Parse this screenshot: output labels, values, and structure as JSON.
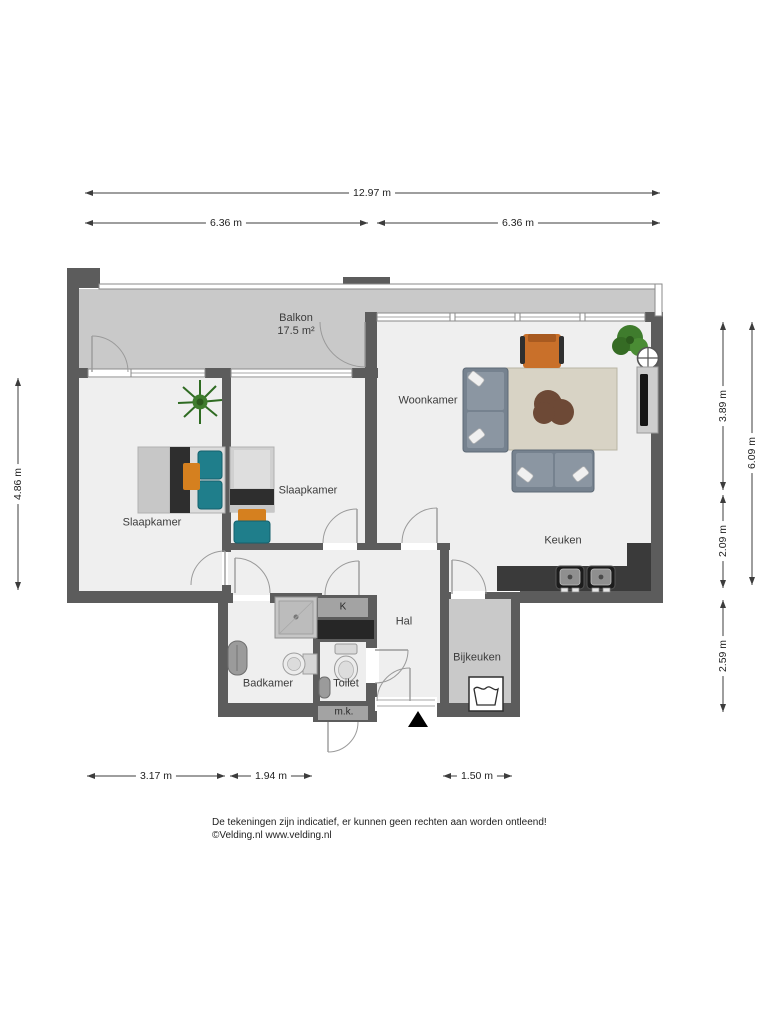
{
  "plan": {
    "rooms": {
      "balkon": {
        "label": "Balkon",
        "area": "17.5 m²"
      },
      "woonkamer": {
        "label": "Woonkamer"
      },
      "slaapkamer_left": {
        "label": "Slaapkamer"
      },
      "slaapkamer_mid": {
        "label": "Slaapkamer"
      },
      "keuken": {
        "label": "Keuken"
      },
      "hal": {
        "label": "Hal"
      },
      "badkamer": {
        "label": "Badkamer"
      },
      "toilet": {
        "label": "Toilet"
      },
      "bijkeuken": {
        "label": "Bijkeuken"
      },
      "kast": {
        "label": "K"
      },
      "meterkast": {
        "label": "m.k."
      }
    },
    "dims": {
      "total_width": "12.97 m",
      "top_left": "6.36 m",
      "top_right": "6.36 m",
      "left_side": "4.86 m",
      "right_upper": "3.89 m",
      "right_middle": "2.09 m",
      "right_lower": "2.59 m",
      "right_total": "6.09 m",
      "bottom_left": "3.17 m",
      "bottom_middle": "1.94 m",
      "bottom_right": "1.50 m"
    },
    "footer": {
      "line1": "De tekeningen zijn indicatief, er kunnen geen rechten aan worden ontleend!",
      "line2": "©Velding.nl www.velding.nl"
    }
  },
  "colors": {
    "wall": "#5c5c5c",
    "floor": "#efefef",
    "balcony": "#c9c9c9",
    "counter": "#3a3a3a",
    "sofa": "#76828f",
    "sofa_light": "#8b96a2",
    "rug": "#d8d3c5",
    "table": "#6d4936",
    "orange": "#c9702a",
    "teal": "#1f7e8b",
    "plant": "#3f7c2d",
    "fixture": "#ececec"
  }
}
